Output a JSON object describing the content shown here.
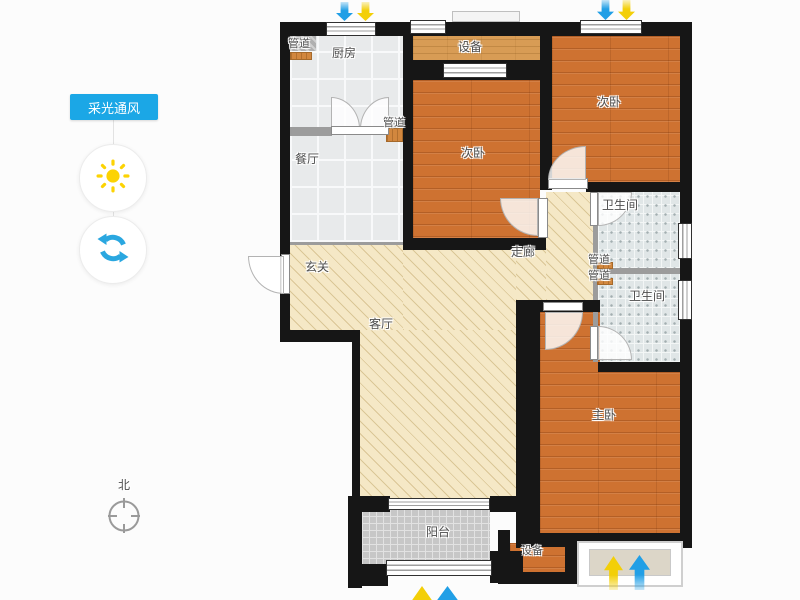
{
  "sidebar": {
    "tool_button": {
      "label": "采光通风",
      "bg": "#1ba7e6"
    },
    "sun_icon_color": "#fcd303",
    "refresh_icon_color": "#2aa7e0",
    "compass": {
      "label": "北"
    }
  },
  "floorplan": {
    "rooms": [
      {
        "id": "duct-kitchen-tl",
        "label": "管道"
      },
      {
        "id": "kitchen",
        "label": "厨房"
      },
      {
        "id": "equipment-top",
        "label": "设备"
      },
      {
        "id": "bedroom2-right",
        "label": "次卧"
      },
      {
        "id": "duct-kitchen-br",
        "label": "管道"
      },
      {
        "id": "bedroom2-mid",
        "label": "次卧"
      },
      {
        "id": "dining-room",
        "label": "餐厅"
      },
      {
        "id": "bath-upper",
        "label": "卫生间"
      },
      {
        "id": "corridor",
        "label": "走廊"
      },
      {
        "id": "duct-shaft-a",
        "label": "管道"
      },
      {
        "id": "duct-shaft-b",
        "label": "管道"
      },
      {
        "id": "foyer",
        "label": "玄关"
      },
      {
        "id": "bath-lower",
        "label": "卫生间"
      },
      {
        "id": "living-room",
        "label": "客厅"
      },
      {
        "id": "master-bedroom",
        "label": "主卧"
      },
      {
        "id": "balcony",
        "label": "阳台"
      },
      {
        "id": "equipment-bottom",
        "label": "设备"
      }
    ],
    "colors": {
      "wall": "#161616",
      "wood_floor": "#ce7231",
      "wood_light": "#d89c55",
      "hatch_floor": "#f5e8c6",
      "kitchen_tile": "#e8eaeb",
      "bath_tile": "#e0e6e7",
      "balcony_tile": "#c7c7c7",
      "arrow_blue": "#219fe6",
      "arrow_yellow": "#f3cf08"
    },
    "airflow_arrows": {
      "top_pairs": 2,
      "bottom_pairs": 2
    }
  }
}
